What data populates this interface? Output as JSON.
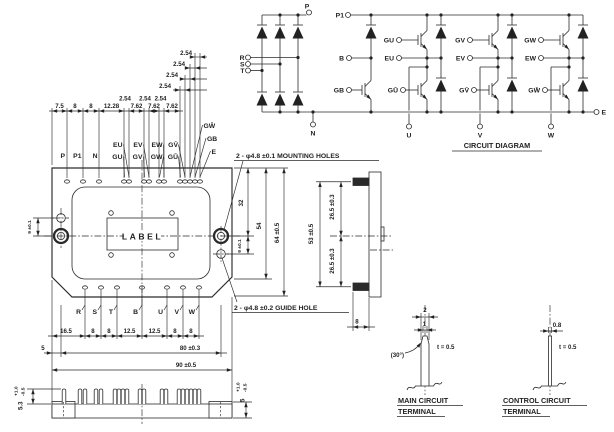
{
  "pins": {
    "p": "P",
    "p1": "P1",
    "n": "N",
    "r": "R",
    "s": "S",
    "t": "T",
    "b": "B",
    "u": "U",
    "v": "V",
    "w": "W",
    "e": "E",
    "gb": "GB",
    "gu": "GU",
    "eu": "EU",
    "gv": "GV",
    "ev": "EV",
    "gw": "GW",
    "ew": "EW",
    "gub": "GŪ",
    "gvb": "GV̄",
    "gwb": "GW̄"
  },
  "dims": {
    "d75": "7.5",
    "d8": "8",
    "d1228": "12.28",
    "d254": "2.54",
    "d762": "7.62",
    "d165": "16.5",
    "d125": "12.5",
    "d5": "5",
    "d80": "80 ±0.3",
    "d90": "90 ±0.5",
    "d32": "32",
    "d54": "54",
    "d64": "64 ±0.5",
    "d9": "9 ±0.1",
    "d53": "53 ±0.5",
    "d265": "26.5 ±0.3",
    "d2": "2",
    "d1": "1",
    "d08": "0.8",
    "t05": "t = 0.5",
    "ang": "(30°)",
    "h53": "5.3",
    "h5": "5",
    "tolp": "+1.0",
    "tolm": "-0.5"
  },
  "notes": {
    "mounting": "2 - φ4.8 ±0.1 MOUNTING HOLES",
    "guide": "2 - φ4.8 ±0.2 GUIDE HOLE",
    "label": "LABEL",
    "circuit": "CIRCUIT DIAGRAM",
    "main1": "MAIN CIRCUIT",
    "ctrl1": "CONTROL CIRCUIT",
    "term": "TERMINAL"
  }
}
